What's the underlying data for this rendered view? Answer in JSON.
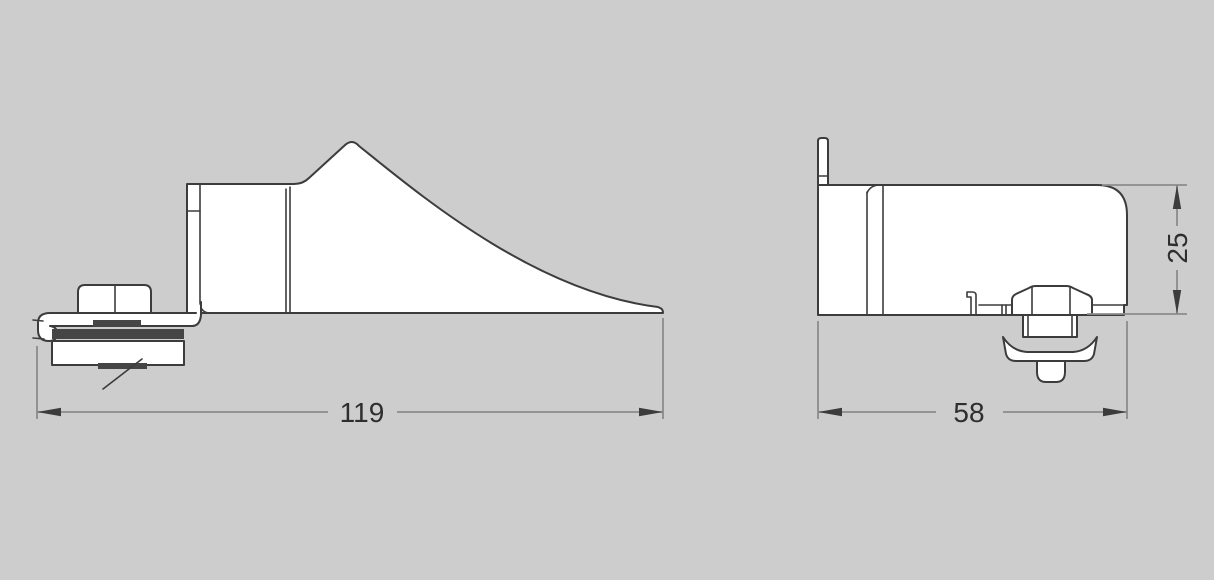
{
  "drawing": {
    "kind": "technical-drawing-two-views",
    "dimensions": {
      "side_width": "119",
      "end_width": "58",
      "end_height": "25"
    },
    "colors": {
      "background": "#cdcdcd",
      "part_outline": "#3c3c3c",
      "part_fill": "#ffffff",
      "rubber_pad": "#454545",
      "dimension_line": "#8c8c8c",
      "dimension_text": "#2e2e2e"
    }
  }
}
